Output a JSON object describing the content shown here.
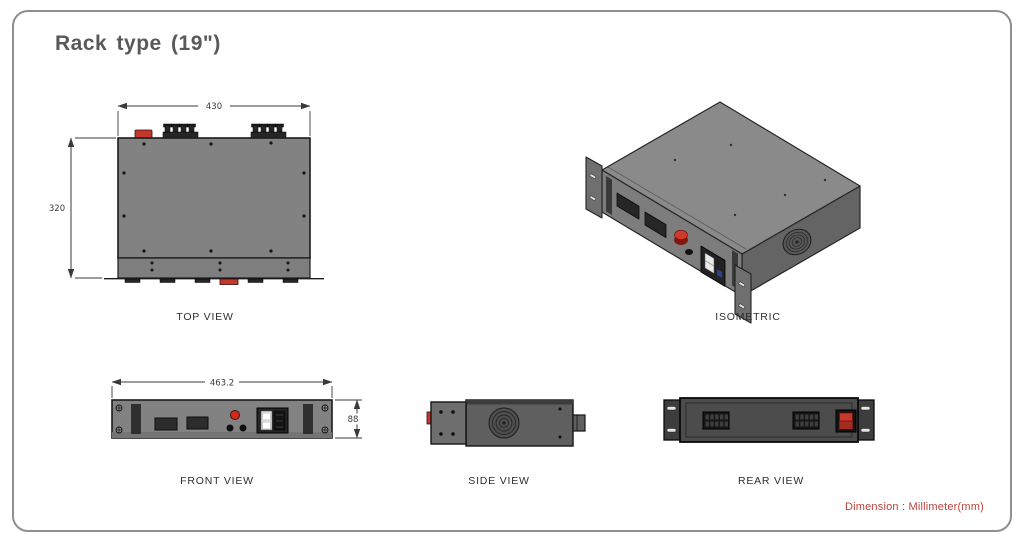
{
  "title": "Rack type (19\")",
  "views": {
    "top": {
      "label": "TOP VIEW",
      "dim_width": "430",
      "dim_height": "320"
    },
    "iso": {
      "label": "ISOMETRIC"
    },
    "front": {
      "label": "FRONT VIEW",
      "dim_width": "463.2",
      "dim_height": "88"
    },
    "side": {
      "label": "SIDE VIEW"
    },
    "rear": {
      "label": "REAR VIEW"
    }
  },
  "footer": {
    "note": "Dimension : Millimeter(mm)"
  },
  "colors": {
    "accent": "#c3382b",
    "note": "#b9423d",
    "chassis": "#828282",
    "dark": "#2b2b2b",
    "line": "#3a3a3a",
    "frame": "#8f8f8f"
  }
}
